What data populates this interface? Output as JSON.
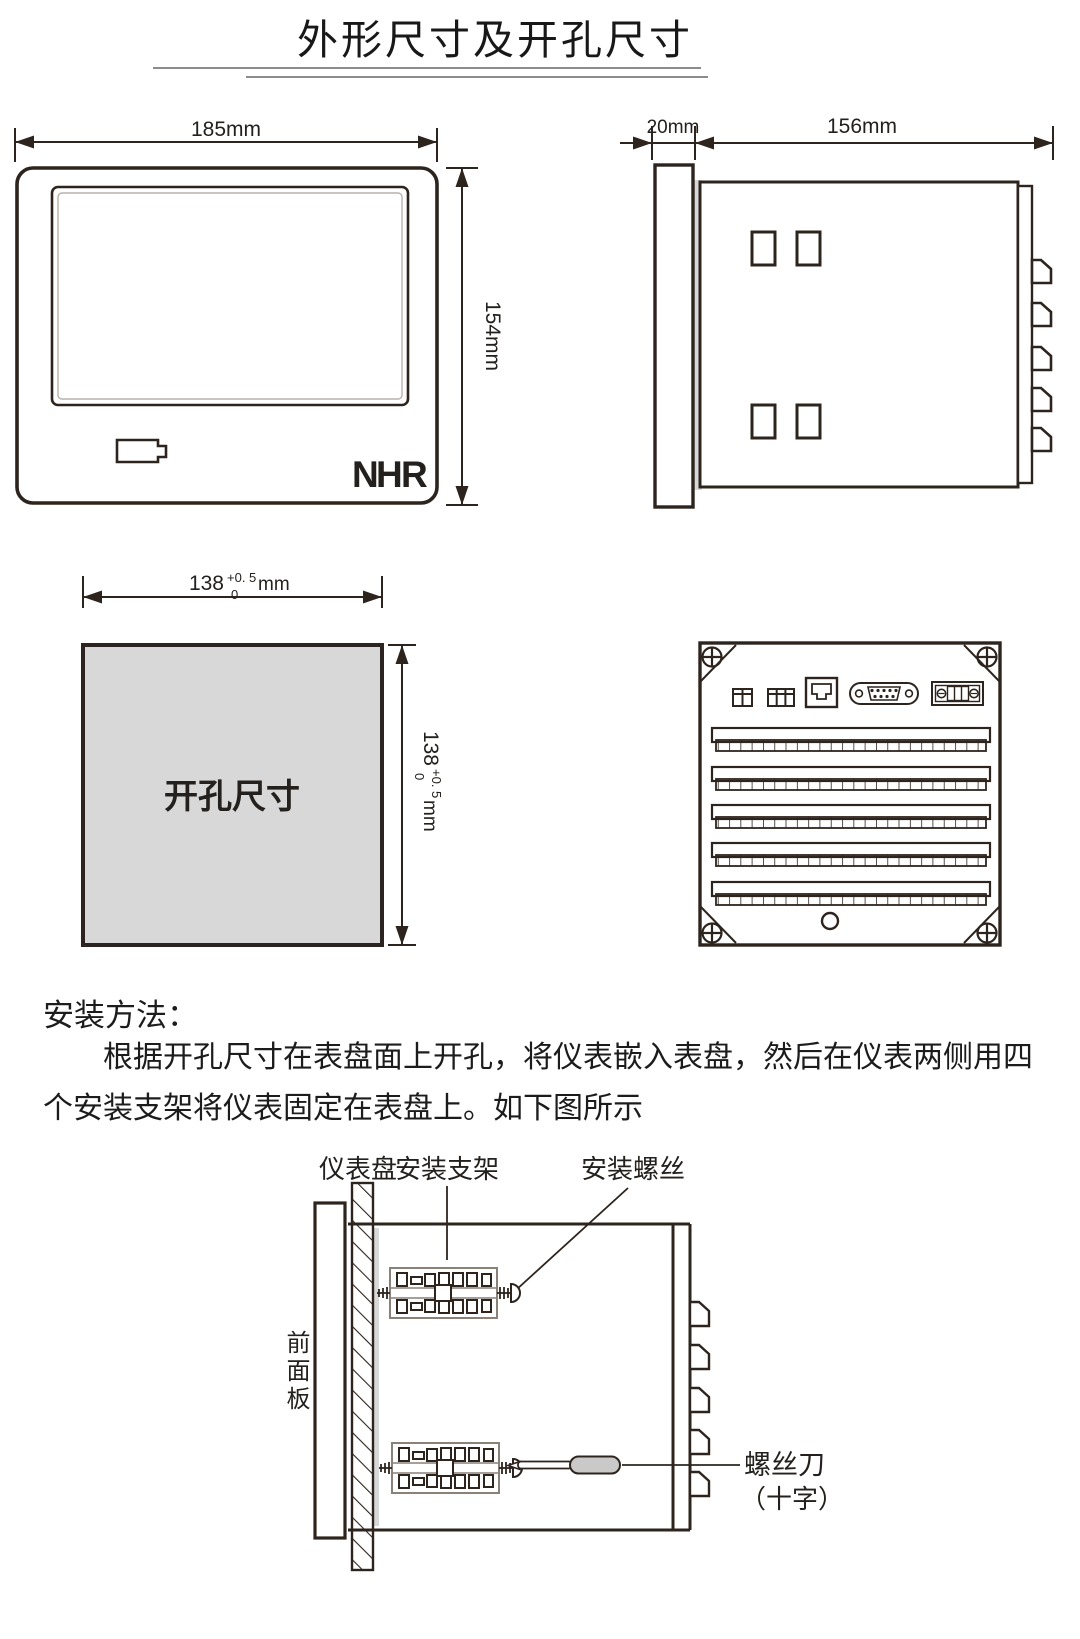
{
  "page": {
    "title": "外形尺寸及开孔尺寸"
  },
  "front_view": {
    "width_dim": "185mm",
    "height_dim": "154mm",
    "logo_n": "N",
    "logo_h": "H",
    "logo_r": "R"
  },
  "side_view": {
    "bezel_dim": "20mm",
    "depth_dim": "156mm"
  },
  "cutout": {
    "label": "开孔尺寸",
    "dim_base": "138",
    "tol_plus": "+0. 5",
    "tol_minus": "0",
    "unit": "mm"
  },
  "install": {
    "heading": "安装方法：",
    "paragraph": "根据开孔尺寸在表盘面上开孔，将仪表嵌入表盘，然后在仪表两侧用四个安装支架将仪表固定在表盘上。如下图所示",
    "labels": {
      "panel": "仪表盘",
      "bracket": "安装支架",
      "mount_screw": "安装螺丝",
      "front_panel": "前面板",
      "screwdriver": "螺丝刀",
      "screwdriver_type": "（十字）"
    }
  },
  "colors": {
    "line": "#2e241e",
    "gray_fill": "#d8d8d8",
    "logo_gray": "#b9b9b9",
    "logo_red": "#cf2b1f",
    "handle_gray": "#c9c9c9"
  }
}
